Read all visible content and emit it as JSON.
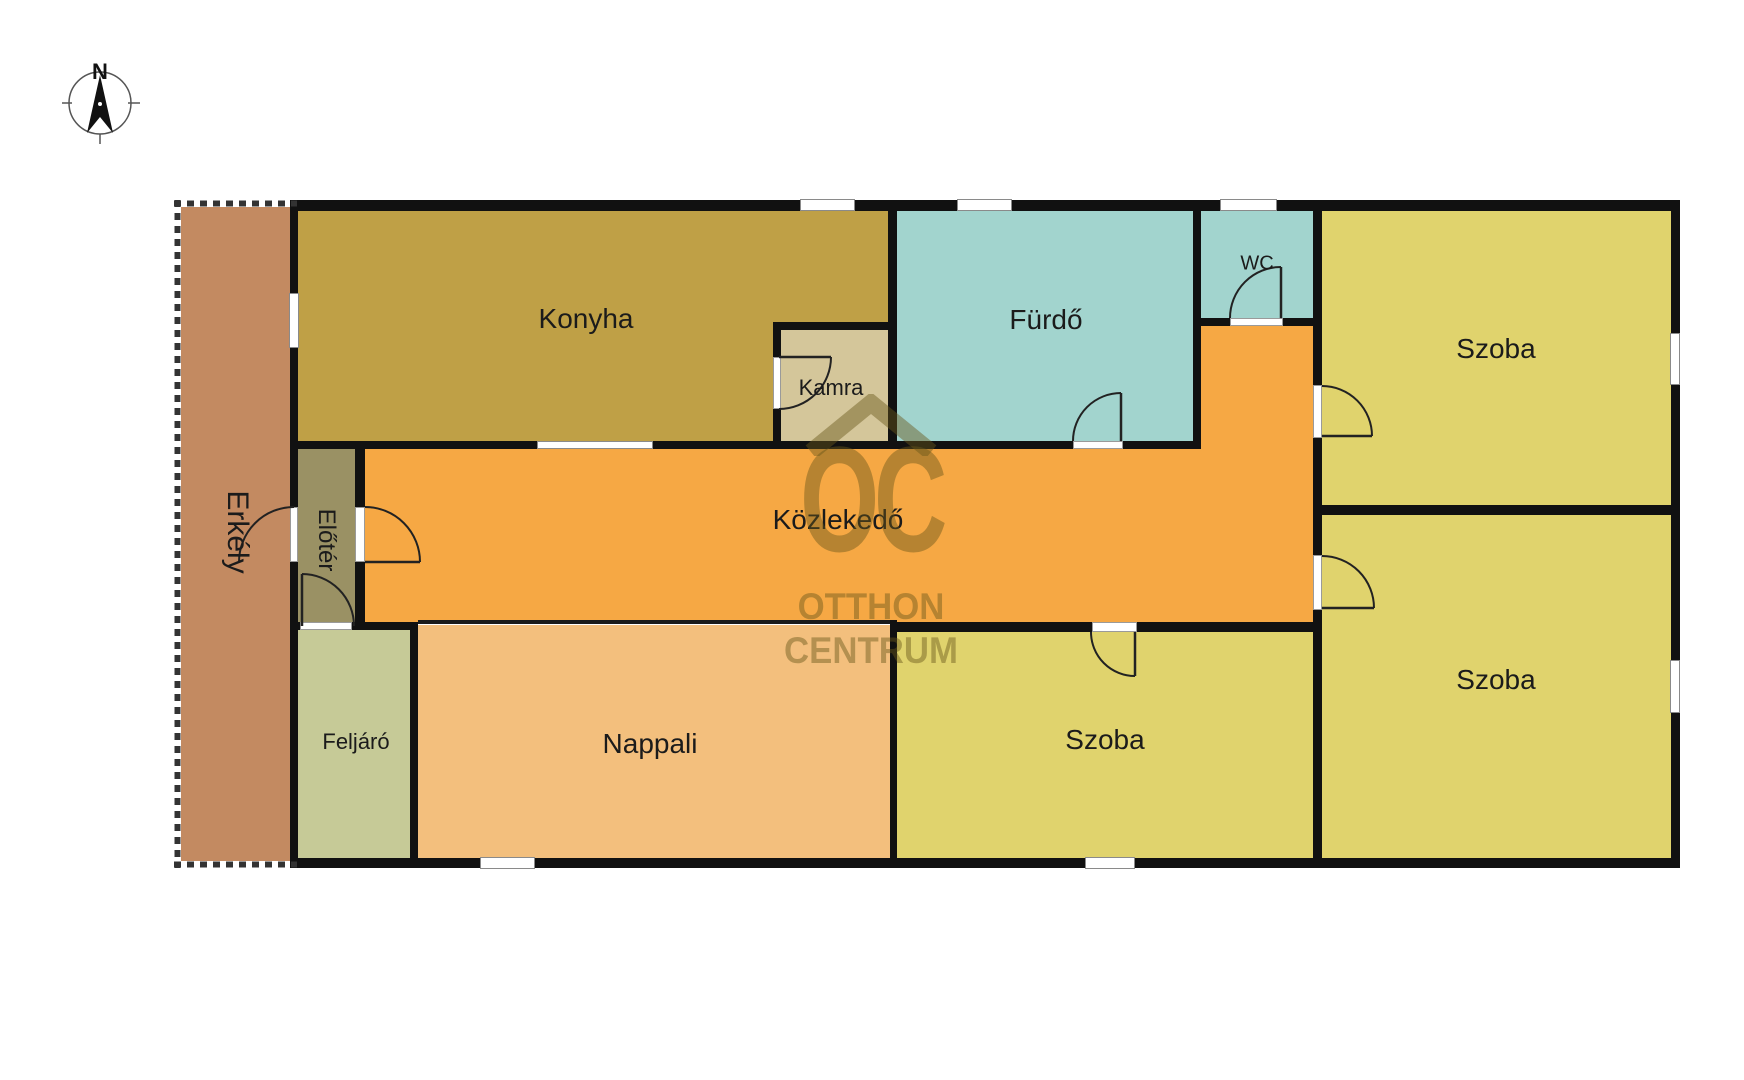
{
  "compass": {
    "north_label": "N"
  },
  "watermark": {
    "monogram": "OC",
    "line1": "OTTHON",
    "line2": "CENTRUM"
  },
  "floorplan": {
    "wall_color": "#111111",
    "label_color": "#1b1b1b",
    "rooms": [
      {
        "id": "erkely",
        "label": "Erkély",
        "x": 174,
        "y": 200,
        "w": 123,
        "h": 668,
        "color": "#c38a61",
        "lx": 237,
        "ly": 532,
        "fs": 30,
        "rot": 90
      },
      {
        "id": "konyha",
        "label": "Konyha",
        "x": 297,
        "y": 211,
        "w": 591,
        "h": 238,
        "color": "#bfa046",
        "lx": 586,
        "ly": 319,
        "fs": 28,
        "rot": 0
      },
      {
        "id": "kamra",
        "label": "Kamra",
        "x": 781,
        "y": 330,
        "w": 107,
        "h": 111,
        "color": "#d4c69a",
        "lx": 831,
        "ly": 388,
        "fs": 22,
        "rot": 0
      },
      {
        "id": "furdo",
        "label": "Fürdő",
        "x": 897,
        "y": 211,
        "w": 296,
        "h": 238,
        "color": "#a2d4ce",
        "lx": 1046,
        "ly": 320,
        "fs": 28,
        "rot": 0
      },
      {
        "id": "wc",
        "label": "WC",
        "x": 1201,
        "y": 211,
        "w": 112,
        "h": 115,
        "color": "#a2d4ce",
        "lx": 1257,
        "ly": 264,
        "fs": 20,
        "rot": 0
      },
      {
        "id": "kozlekedo",
        "label": "Közlekedő",
        "x": 365,
        "y": 449,
        "w": 948,
        "h": 173,
        "color": "#f6a844",
        "lx": 838,
        "ly": 520,
        "fs": 28,
        "rot": 0
      },
      {
        "id": "kozlekedo-arm",
        "label": "",
        "x": 1201,
        "y": 326,
        "w": 112,
        "h": 123,
        "color": "#f6a844",
        "lx": 0,
        "ly": 0,
        "fs": 0,
        "rot": 0
      },
      {
        "id": "eloter",
        "label": "Előtér",
        "x": 298,
        "y": 449,
        "w": 57,
        "h": 173,
        "color": "#9a9164",
        "lx": 326,
        "ly": 540,
        "fs": 24,
        "rot": 90
      },
      {
        "id": "feljaro",
        "label": "Feljáró",
        "x": 298,
        "y": 630,
        "w": 112,
        "h": 228,
        "color": "#c6ca97",
        "lx": 356,
        "ly": 742,
        "fs": 22,
        "rot": 0
      },
      {
        "id": "nappali",
        "label": "Nappali",
        "x": 418,
        "y": 625,
        "w": 472,
        "h": 233,
        "color": "#f3bf7d",
        "lx": 650,
        "ly": 744,
        "fs": 28,
        "rot": 0
      },
      {
        "id": "szoba-kozepso",
        "label": "Szoba",
        "x": 897,
        "y": 632,
        "w": 416,
        "h": 226,
        "color": "#e0d36d",
        "lx": 1105,
        "ly": 740,
        "fs": 28,
        "rot": 0
      },
      {
        "id": "szoba-felso",
        "label": "Szoba",
        "x": 1322,
        "y": 211,
        "w": 349,
        "h": 294,
        "color": "#e0d36d",
        "lx": 1496,
        "ly": 349,
        "fs": 28,
        "rot": 0
      },
      {
        "id": "szoba-also",
        "label": "Szoba",
        "x": 1322,
        "y": 515,
        "w": 349,
        "h": 343,
        "color": "#e0d36d",
        "lx": 1496,
        "ly": 680,
        "fs": 28,
        "rot": 0
      }
    ],
    "walls": [
      [
        297,
        200,
        1383,
        11
      ],
      [
        290,
        858,
        1390,
        10
      ],
      [
        1671,
        200,
        9,
        668
      ],
      [
        290,
        200,
        8,
        668
      ],
      [
        888,
        200,
        9,
        249
      ],
      [
        773,
        322,
        8,
        127
      ],
      [
        773,
        322,
        124,
        8
      ],
      [
        290,
        441,
        908,
        8
      ],
      [
        1193,
        200,
        8,
        249
      ],
      [
        1193,
        318,
        120,
        8
      ],
      [
        1313,
        200,
        9,
        668
      ],
      [
        1313,
        505,
        367,
        10
      ],
      [
        355,
        441,
        10,
        189
      ],
      [
        290,
        622,
        128,
        8
      ],
      [
        890,
        622,
        423,
        10
      ],
      [
        890,
        620,
        7,
        248
      ],
      [
        410,
        622,
        8,
        246
      ]
    ],
    "thin_walls": [
      [
        418,
        620,
        472,
        4
      ]
    ],
    "windows": [
      {
        "x": 289,
        "y": 293,
        "w": 10,
        "h": 55
      },
      {
        "x": 800,
        "y": 199,
        "w": 55,
        "h": 12
      },
      {
        "x": 957,
        "y": 199,
        "w": 55,
        "h": 12
      },
      {
        "x": 1220,
        "y": 199,
        "w": 57,
        "h": 12
      },
      {
        "x": 1670,
        "y": 333,
        "w": 10,
        "h": 52
      },
      {
        "x": 1670,
        "y": 660,
        "w": 10,
        "h": 53
      },
      {
        "x": 480,
        "y": 857,
        "w": 55,
        "h": 12
      },
      {
        "x": 1085,
        "y": 857,
        "w": 50,
        "h": 12
      },
      {
        "x": 537,
        "y": 441,
        "w": 116,
        "h": 8
      }
    ],
    "door_gaps": [
      {
        "x": 290,
        "y": 507,
        "w": 8,
        "h": 55
      },
      {
        "x": 355,
        "y": 507,
        "w": 10,
        "h": 55
      },
      {
        "x": 300,
        "y": 622,
        "w": 52,
        "h": 8
      },
      {
        "x": 773,
        "y": 357,
        "w": 8,
        "h": 52
      },
      {
        "x": 1073,
        "y": 441,
        "w": 50,
        "h": 8
      },
      {
        "x": 1230,
        "y": 318,
        "w": 53,
        "h": 8
      },
      {
        "x": 1313,
        "y": 385,
        "w": 9,
        "h": 53
      },
      {
        "x": 1313,
        "y": 555,
        "w": 9,
        "h": 55
      },
      {
        "x": 1092,
        "y": 622,
        "w": 45,
        "h": 10
      }
    ],
    "door_arcs": [
      {
        "arc": "M294,507 A55,55 0 0 0 239,562",
        "leaf": ""
      },
      {
        "arc": "M365,507 A55,55 0 0 1 420,562",
        "leaf": "M365,562 L420,562"
      },
      {
        "arc": "M302,574 A52,52 0 0 1 354,626",
        "leaf": "M302,626 L302,574"
      },
      {
        "arc": "M831,357 A52,52 0 0 1 779,409",
        "leaf": "M779,357 L831,357"
      },
      {
        "arc": "M1121,393 A48,48 0 0 0 1073,441",
        "leaf": "M1121,441 L1121,393"
      },
      {
        "arc": "M1281,267 A51,51 0 0 0 1230,318",
        "leaf": "M1281,318 L1281,267"
      },
      {
        "arc": "M1322,386 A50,50 0 0 1 1372,436",
        "leaf": "M1322,436 L1372,436"
      },
      {
        "arc": "M1322,556 A52,52 0 0 1 1374,608",
        "leaf": "M1322,608 L1374,608"
      },
      {
        "arc": "M1091,632 A44,44 0 0 0 1135,676",
        "leaf": "M1135,632 L1135,676"
      }
    ],
    "hatches": [
      {
        "x": 174,
        "y": 200,
        "w": 7,
        "h": 668,
        "x1": 177.5,
        "y1": 200,
        "x2": 177.5,
        "y2": 868
      },
      {
        "x": 174,
        "y": 200,
        "w": 123,
        "h": 7,
        "x1": 174,
        "y1": 203.5,
        "x2": 297,
        "y2": 203.5
      },
      {
        "x": 174,
        "y": 861,
        "w": 123,
        "h": 7,
        "x1": 174,
        "y1": 864.5,
        "x2": 297,
        "y2": 864.5
      }
    ]
  }
}
